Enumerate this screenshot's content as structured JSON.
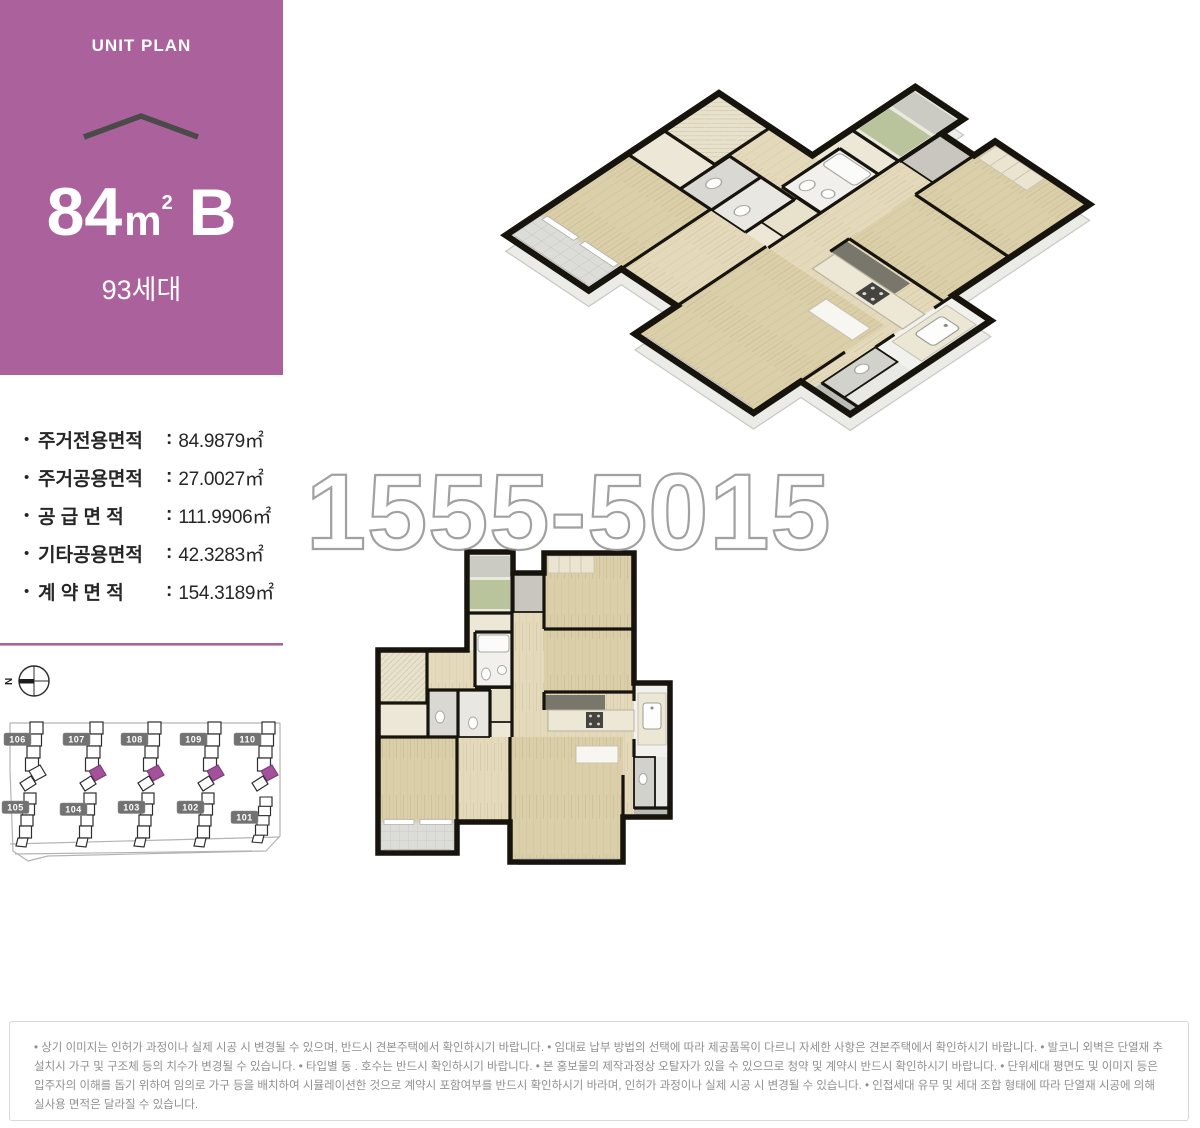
{
  "unit_panel": {
    "eyebrow": "UNIT PLAN",
    "area_number": "84",
    "area_unit_base": "m",
    "area_unit_exp": "2",
    "type_letter": "B",
    "households": "93세대"
  },
  "areas": {
    "bullet": "•",
    "separator": ":",
    "items": [
      {
        "label": "주거전용면적",
        "value": "84.9879㎡"
      },
      {
        "label": "주거공용면적",
        "value": "27.0027㎡"
      },
      {
        "label": "공 급 면 적",
        "value": "111.9906㎡"
      },
      {
        "label": "기타공용면적",
        "value": "42.3283㎡"
      },
      {
        "label": "계 약 면 적",
        "value": "154.3189㎡"
      }
    ]
  },
  "site_plan": {
    "compass_label": "N",
    "buildings_top": [
      {
        "id": "106",
        "highlighted": false
      },
      {
        "id": "107",
        "highlighted": true
      },
      {
        "id": "108",
        "highlighted": true
      },
      {
        "id": "109",
        "highlighted": true
      },
      {
        "id": "110",
        "highlighted": true
      }
    ],
    "buildings_bottom": [
      {
        "id": "105"
      },
      {
        "id": "104"
      },
      {
        "id": "103"
      },
      {
        "id": "102"
      },
      {
        "id": "101"
      }
    ],
    "highlight_color": "#A4519C"
  },
  "watermark": "1555-5015",
  "colors": {
    "accent": "#AB619C",
    "wall": "#17130D"
  },
  "footer": {
    "lines": [
      "• 상기 이미지는 인허가 과정이나 실제 시공 시 변경될 수 있으며, 반드시 견본주택에서 확인하시기 바랍니다.  • 임대료 납부 방법의 선택에 따라 제공품목이 다르니 자세한 사항은 견본주택에서 확인하시기 바랍니다.  • 발코니 외벽은 단열재 추가",
      "설치시 가구 및 구조체 등의 치수가 변경될 수 있습니다.  • 타입별 동 . 호수는 반드시 확인하시기 바랍니다.  • 본 홍보물의 제작과정상 오탈자가 있을 수 있으므로 청약 및 계약시 반드시 확인하시기 바랍니다.  • 단위세대 평면도 및 이미지 등은",
      "입주자의 이해를 돕기 위하여 임의로 가구 등을 배치하여 시뮬레이션한 것으로 계약시 포함여부를 반드시 확인하시기 바라며, 인허가 과정이나 실제 시공 시 변경될 수 있습니다.  • 인접세대 유무 및 세대 조합 형태에 따라 단열재 시공에 의해",
      "실사용 면적은 달라질 수 있습니다."
    ]
  }
}
